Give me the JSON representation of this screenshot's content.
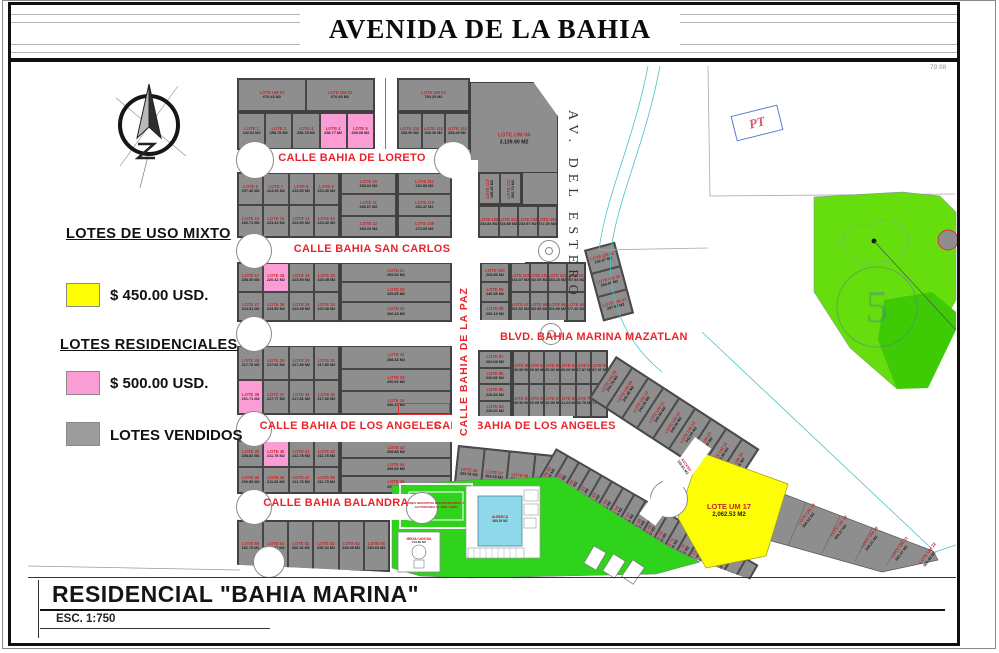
{
  "avenue": "AVENIDA DE LA BAHIA",
  "legend": {
    "title_mixto": "LOTES DE USO MIXTO",
    "price_mixto": "$ 450.00  USD.",
    "title_res": "LOTES RESIDENCIALES",
    "price_res": "$ 500.00  USD.",
    "vendidos": "LOTES VENDIDOS",
    "color_mixto": "#fdfd05",
    "color_res": "#fb9dd4",
    "color_vendidos": "#9c9c9c"
  },
  "titleblock": {
    "name": "RESIDENCIAL \"BAHIA MARINA\"",
    "esc": "ESC. 1:750"
  },
  "streets": {
    "loreto": "CALLE BAHIA DE LORETO",
    "san_carlos": "CALLE  BAHIA SAN CARLOS",
    "blvd": "BLVD.  BAHIA MARINA MAZATLAN",
    "angeles_left": "CALLE BAHIA DE LOS ANGELES",
    "angeles_right": "CALLE BAHIA DE LOS ANGELES",
    "balandra": "CALLE BAHIA BALANDRA",
    "la_paz": "CALLE  BAHIA  DE  LA  PAZ",
    "estero": "AV.  DEL  ESTERO"
  },
  "misc": {
    "pt": "PT",
    "golf_hole": "5",
    "dim": "79.98",
    "acceso": "ACCESO",
    "acceso_a": "102.61 M2"
  },
  "green": {
    "sport": "AREA DEPORTIVA MULTIFUNCIONAL Y ACTIVIDADES AL AIRE LIBRE",
    "pool": "ALBERCA",
    "pool_a": "560.29 M2",
    "court": "MEDIA CANCHA",
    "court_a": "213.89 M2"
  },
  "um": {
    "um04_n": "LOTE UM 04",
    "um04_a": "3,139.90 M2",
    "um17_n": "LOTE  UM 17",
    "um17_a": "2,062.53 M2"
  },
  "lots": {
    "top_um": [
      {
        "n": "LOTE UM 01",
        "a": "670.43 M2"
      },
      {
        "n": "LOTE UM 02",
        "a": "670.45 M2"
      }
    ],
    "um03row": [
      {
        "n": "LOTE UM 03",
        "a": "793.20 M2"
      }
    ],
    "row1_5": [
      {
        "n": "LOTE 1",
        "a": "242.62 M2"
      },
      {
        "n": "LOTE 2",
        "a": "258.79 M2"
      },
      {
        "n": "LOTE 3",
        "a": "258.78 M2"
      },
      {
        "n": "LOTE 4",
        "a": "258.77 M2",
        "cls": "pink"
      },
      {
        "n": "LOTE 5",
        "a": "258.08 M2",
        "cls": "pink"
      }
    ],
    "row114": [
      {
        "n": "LOTE 116",
        "a": "268.90 M2"
      },
      {
        "n": "LOTE 115",
        "a": "269.46 M2"
      },
      {
        "n": "LOTE 114",
        "a": "254.49 M2"
      }
    ],
    "grid6": [
      {
        "n": "LOTE 6",
        "a": "297.46 M2"
      },
      {
        "n": "LOTE 7",
        "a": "223.39 M2"
      },
      {
        "n": "LOTE 8",
        "a": "223.50 M2"
      },
      {
        "n": "LOTE 9",
        "a": "223.40 M2"
      },
      {
        "n": "LOTE 16",
        "a": "266.71 M2"
      },
      {
        "n": "LOTE 15",
        "a": "223.34 M2"
      },
      {
        "n": "LOTE 14",
        "a": "223.50 M2"
      },
      {
        "n": "LOTE 13",
        "a": "223.40 M2"
      }
    ],
    "col10": [
      {
        "n": "LOTE 10",
        "a": "266.02 M2"
      },
      {
        "n": "LOTE 11",
        "a": "266.67 M2"
      },
      {
        "n": "LOTE 12",
        "a": "266.03 M2"
      }
    ],
    "col111": [
      {
        "n": "LOTE 111",
        "a": "262.53 M2"
      },
      {
        "n": "LOTE 110",
        "a": "262.47 M2"
      },
      {
        "n": "LOTE 109",
        "a": "273.05 M2"
      }
    ],
    "rot112": [
      {
        "n": "LOTE 113",
        "a": "198.36 M2"
      },
      {
        "n": "LOTE 112",
        "a": "202.73 M2"
      }
    ],
    "row105": [
      {
        "n": "LOTE 108",
        "a": "233.84 M2"
      },
      {
        "n": "LOTE 107",
        "a": "233.85 M2"
      },
      {
        "n": "LOTE 106",
        "a": "233.97 M2"
      },
      {
        "n": "LOTE 105",
        "a": "217.26 M2"
      }
    ],
    "grid17": [
      {
        "n": "LOTE 17",
        "a": "208.30 M2"
      },
      {
        "n": "LOTE 18",
        "a": "220.42 M2",
        "cls": "pink"
      },
      {
        "n": "LOTE 19",
        "a": "223.50 M2"
      },
      {
        "n": "LOTE 20",
        "a": "225.45 M2"
      },
      {
        "n": "LOTE 27",
        "a": "223.51 M2"
      },
      {
        "n": "LOTE 26",
        "a": "223.50 M2"
      },
      {
        "n": "LOTE 25",
        "a": "223.49 M2"
      },
      {
        "n": "LOTE 24",
        "a": "220.38 M2"
      }
    ],
    "col21": [
      {
        "n": "LOTE 21",
        "a": "265.84 M2"
      },
      {
        "n": "LOTE 22",
        "a": "265.85 M2"
      },
      {
        "n": "LOTE 23",
        "a": "266.18 M2"
      }
    ],
    "col100": [
      {
        "n": "LOTE 100",
        "a": "265.85 M2"
      },
      {
        "n": "LOTE 99",
        "a": "246.58 M2"
      },
      {
        "n": "LOTE 98",
        "a": "266.19 M2"
      }
    ],
    "grid101": [
      {
        "n": "LOTE 101",
        "a": "242.07 M2"
      },
      {
        "n": "LOTE 102",
        "a": "242.05 M2"
      },
      {
        "n": "LOTE 103",
        "a": "233.23 M2"
      },
      {
        "n": "LOTE 104",
        "a": "207.93 M2"
      },
      {
        "n": "LOTE 97",
        "a": "262.92 M2"
      },
      {
        "n": "LOTE 96",
        "a": "262.95 M2"
      },
      {
        "n": "LOTE 95",
        "a": "202.99 M2"
      },
      {
        "n": "LOTE 94",
        "a": "277.46 M2"
      }
    ],
    "colum5": [
      {
        "n": "LOTE UM 05",
        "a": "242.07 M2"
      },
      {
        "n": "LOTE UM 06",
        "a": "250.06 M2"
      },
      {
        "n": "LOTE UM 07",
        "a": "297.92 M2"
      }
    ],
    "grid28": [
      {
        "n": "LOTE 28",
        "a": "217.76 M2"
      },
      {
        "n": "LOTE 29",
        "a": "217.66 M2"
      },
      {
        "n": "LOTE 30",
        "a": "217.89 M2"
      },
      {
        "n": "LOTE 31",
        "a": "217.80 M2"
      },
      {
        "n": "LOTE 38",
        "a": "201.71 M2",
        "cls": "pink"
      },
      {
        "n": "LOTE 37",
        "a": "217.77 M2"
      },
      {
        "n": "LOTE 36",
        "a": "217.81 M2"
      },
      {
        "n": "LOTE 35",
        "a": "217.80 M2"
      }
    ],
    "col32": [
      {
        "n": "LOTE 32",
        "a": "258.34 M2"
      },
      {
        "n": "LOTE 33",
        "a": "260.00 M2"
      },
      {
        "n": "LOTE 34",
        "a": "256.37 M2"
      }
    ],
    "col87": [
      {
        "n": "LOTE 87",
        "a": "262.08 M2"
      },
      {
        "n": "LOTE 86",
        "a": "226.66 M2"
      },
      {
        "n": "LOTE 85",
        "a": "226.84 M2"
      },
      {
        "n": "LOTE 84",
        "a": "226.00 M2"
      }
    ],
    "grid88": [
      {
        "n": "LOTE 88",
        "a": "220.50 M2"
      },
      {
        "n": "LOTE 89",
        "a": "220.50 M2"
      },
      {
        "n": "LOTE 90",
        "a": "220.00 M2"
      },
      {
        "n": "LOTE 91",
        "a": "220.00 M2"
      },
      {
        "n": "LOTE 92",
        "a": "217.87 M2"
      },
      {
        "n": "LOTE 93",
        "a": "267.07 M2"
      },
      {
        "n": "LOTE 83",
        "a": "220.50 M2"
      },
      {
        "n": "LOTE 82",
        "a": "220.00 M2"
      },
      {
        "n": "LOTE 81",
        "a": "220.00 M2"
      },
      {
        "n": "LOTE 80",
        "a": "321.23 M2"
      },
      {
        "n": "LOTE 79",
        "a": "252.79 M2"
      },
      {
        "n": "LOTE 78",
        "a": "277.02 M2"
      }
    ],
    "grid39": [
      {
        "n": "LOTE 39",
        "a": "208.82 M2"
      },
      {
        "n": "LOTE 40",
        "a": "211.78 M2",
        "cls": "pink"
      },
      {
        "n": "LOTE 41",
        "a": "211.78 M2"
      },
      {
        "n": "LOTE 42",
        "a": "211.78 M2"
      },
      {
        "n": "LOTE 49",
        "a": "206.89 M2"
      },
      {
        "n": "LOTE 48",
        "a": "211.84 M2"
      },
      {
        "n": "LOTE 47",
        "a": "211.75 M2"
      },
      {
        "n": "LOTE 46",
        "a": "211.75 M2"
      }
    ],
    "col43": [
      {
        "n": "LOTE 43",
        "a": "255.88 M2"
      },
      {
        "n": "LOTE 44",
        "a": "259.60 M2"
      },
      {
        "n": "LOTE 45",
        "a": "255.60 M2"
      }
    ],
    "row50": [
      {
        "n": "LOTE 50",
        "a": "181.76 M2"
      },
      {
        "n": "LOTE 51",
        "a": "180.77 M2"
      },
      {
        "n": "LOTE 52",
        "a": "206.26 M2"
      },
      {
        "n": "LOTE 53",
        "a": "226.34 M2"
      },
      {
        "n": "LOTE 54",
        "a": "240.09 M2"
      },
      {
        "n": "LOTE 55",
        "a": "250.64 M2"
      }
    ],
    "row56": [
      {
        "n": "LOTE 56",
        "a": "264.78 M2"
      },
      {
        "n": "LOTE 57",
        "a": "264.00 M2"
      },
      {
        "n": "LOTE 58",
        "a": "264.00 M2"
      },
      {
        "n": "LOTE 59",
        "a": "264.00 M2"
      }
    ],
    "fan_um": [
      {
        "n": "LOTE UM 08",
        "a": "254.78 M2"
      },
      {
        "n": "LOTE UM 09",
        "a": "242.48 M2"
      },
      {
        "n": "LOTE UM 10",
        "a": "242.06 M2"
      },
      {
        "n": "LOTE UM 11",
        "a": "243.05 M2"
      },
      {
        "n": "LOTE UM 12",
        "a": "248.06 M2"
      },
      {
        "n": "LOTE UM 13",
        "a": "342.09 M2"
      },
      {
        "n": "LOTE UM 14",
        "a": "242.30 M2"
      },
      {
        "n": "LOTE UM 15",
        "a": "242.86 M2"
      },
      {
        "n": "LOTE UM 16",
        "a": "242.86 M2"
      }
    ],
    "fan_low": [
      {
        "n": "LOTE 60",
        "a": "264.00 M2"
      },
      {
        "n": "LOTE 61",
        "a": "264.00 M2"
      },
      {
        "n": "LOTE 62",
        "a": "318.81 M2"
      },
      {
        "n": "LOTE 63",
        "a": "319.51 M2"
      },
      {
        "n": "LOTE 64",
        "a": "268.15 M2"
      },
      {
        "n": "LOTE 65",
        "a": "268.15 M2"
      },
      {
        "n": "LOTE 66",
        "a": "266.16 M2"
      },
      {
        "n": "LOTE 67",
        "a": "263.26 M2"
      },
      {
        "n": "LOTE 68",
        "a": "268.67 M2"
      },
      {
        "n": "LOTE 69",
        "a": "272.02 M2"
      },
      {
        "n": "LOTE 70",
        "a": "257.63 M2"
      },
      {
        "n": "LOTE 71",
        "a": "217.06 M2"
      },
      {
        "n": "LOTE 72",
        "a": "220.02 M2"
      },
      {
        "n": "LOTE 73",
        "a": "226.56 M2"
      },
      {
        "n": "LOTE 74",
        "a": "231.30 M2"
      },
      {
        "n": "LOTE 75",
        "a": "236.40 M2"
      },
      {
        "n": "LOTE 76",
        "a": "225.56 M2"
      },
      {
        "n": "LOTE 77",
        "a": "249.95 M2"
      }
    ]
  },
  "tail": [
    {
      "n": "LOTE UM 18",
      "a": "355.52 M2"
    },
    {
      "n": "LOTE UM 19",
      "a": "434.27 M2"
    },
    {
      "n": "LOTE UM 20",
      "a": "348.21 M2"
    },
    {
      "n": "LOTE UM 21",
      "a": "361.47 M2"
    },
    {
      "n": "LOTE UM 22",
      "a": "365.48 M2"
    }
  ]
}
